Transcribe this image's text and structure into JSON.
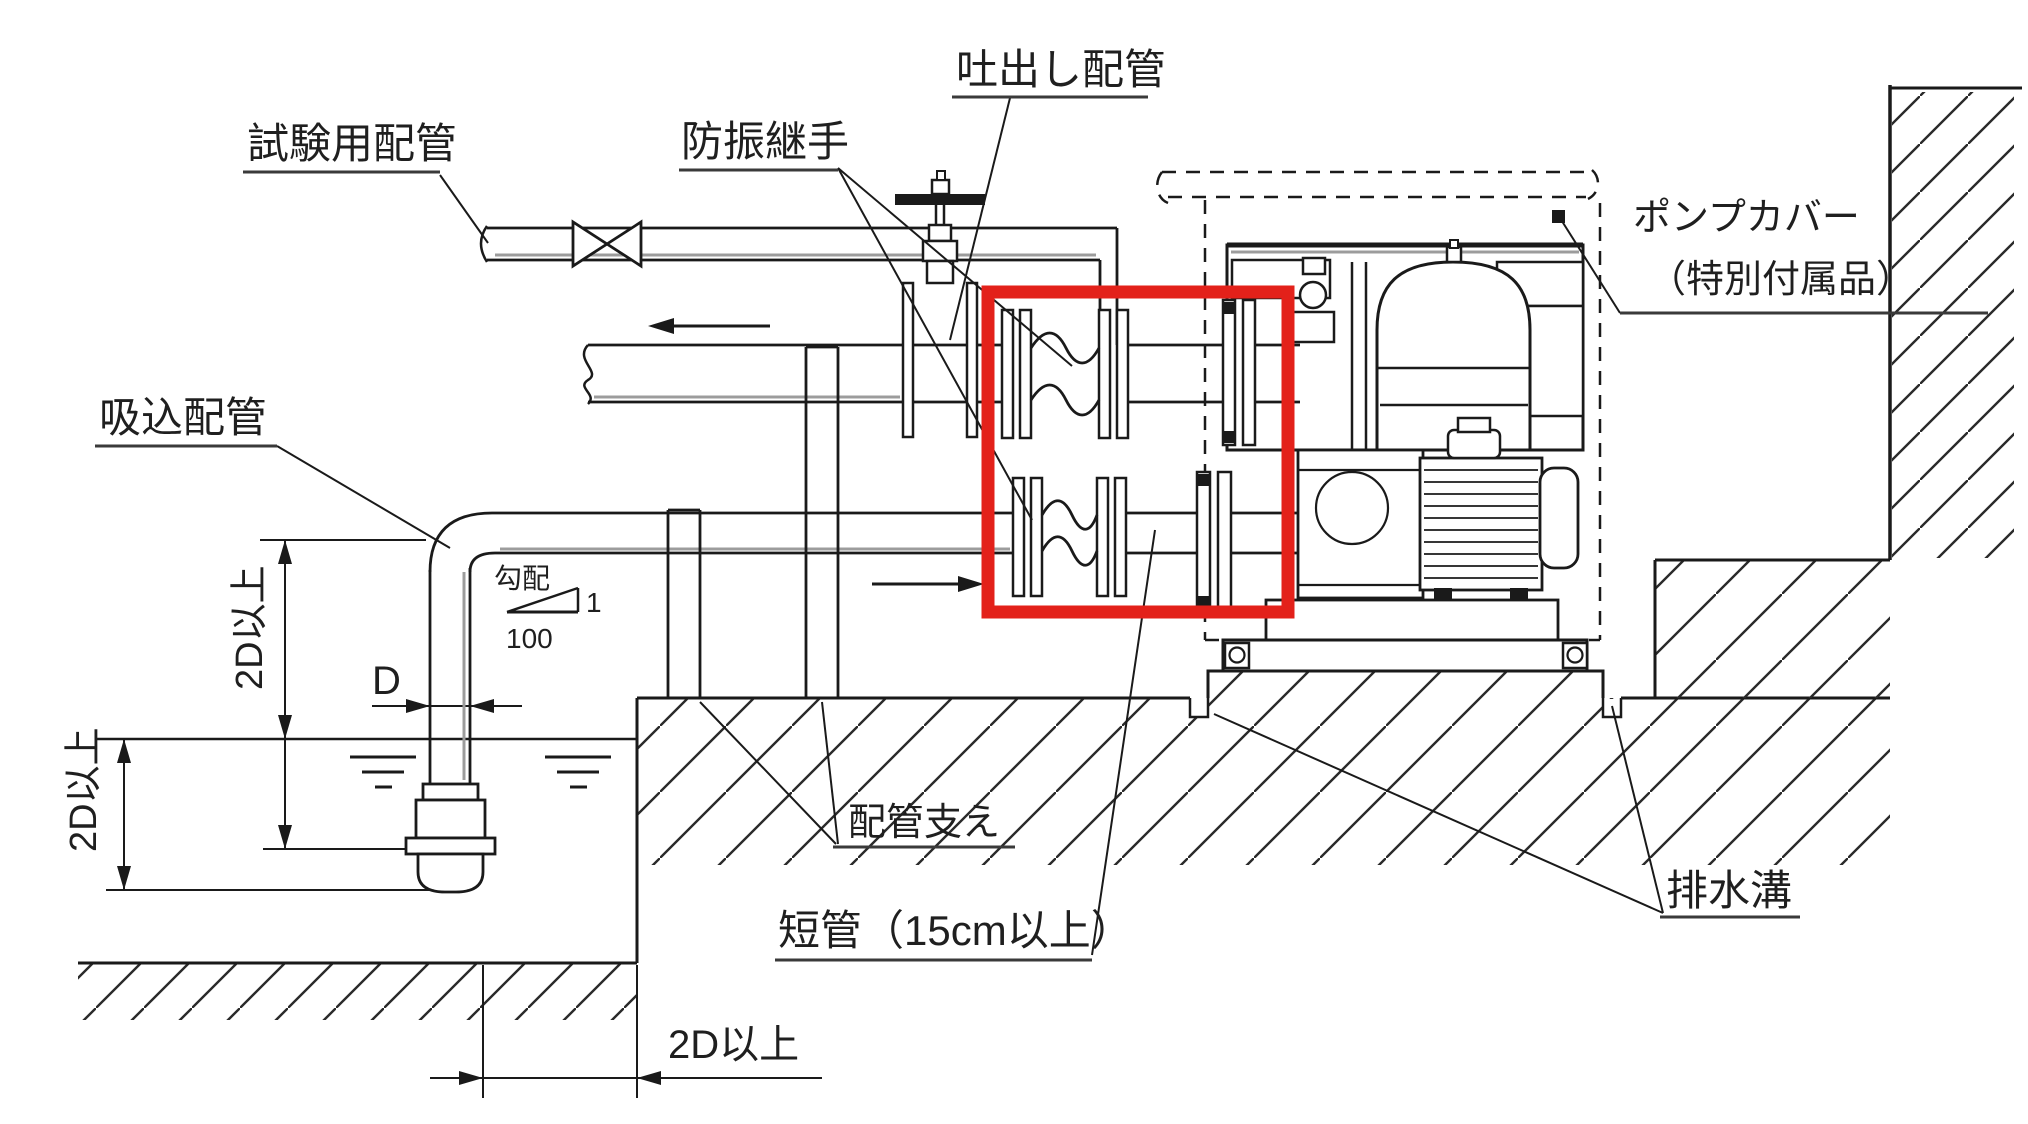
{
  "labels": {
    "test_piping": "試験用配管",
    "vibration_joint": "防振継手",
    "discharge_piping": "吐出し配管",
    "pump_cover_1": "ポンプカバー",
    "pump_cover_2": "（特別付属品）",
    "suction_piping": "吸込配管",
    "pipe_support": "配管支え",
    "short_pipe": "短管（15cm以上）",
    "drain_ditch": "排水溝",
    "slope": "勾配",
    "slope_numerator": "1",
    "slope_denominator": "100",
    "dim_d": "D",
    "dim_2d": "2D以上"
  },
  "colors": {
    "highlight_box": "#e3211a",
    "line": "#1a1a1a",
    "shade": "#9c9c9c"
  }
}
